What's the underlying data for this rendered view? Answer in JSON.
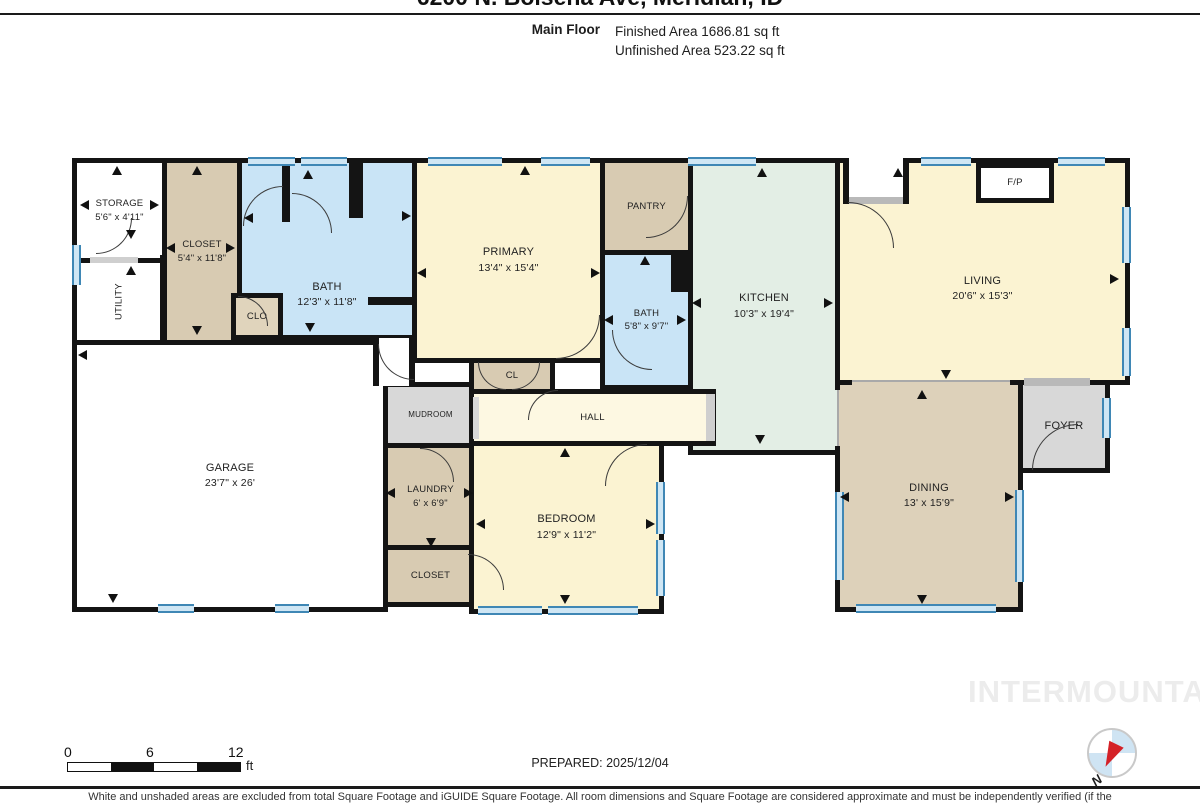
{
  "header": {
    "title": "6200 N. Bolsena Ave, Meridian, ID",
    "floor_label": "Main Floor",
    "finished_area": "Finished Area 1686.81 sq ft",
    "unfinished_area": "Unfinished Area 523.22 sq ft"
  },
  "rooms": {
    "storage": {
      "name": "STORAGE",
      "dims": "5'6\" x 4'11\""
    },
    "utility": {
      "name": "UTILITY",
      "dims": ""
    },
    "closet1": {
      "name": "CLOSET",
      "dims": "5'4\" x 11'8\""
    },
    "bath1": {
      "name": "BATH",
      "dims": "12'3\" x 11'8\""
    },
    "clo": {
      "name": "CLO",
      "dims": ""
    },
    "primary": {
      "name": "PRIMARY",
      "dims": "13'4\" x 15'4\""
    },
    "cl": {
      "name": "CL",
      "dims": ""
    },
    "pantry": {
      "name": "PANTRY",
      "dims": ""
    },
    "bath2": {
      "name": "BATH",
      "dims": "5'8\" x 9'7\""
    },
    "kitchen": {
      "name": "KITCHEN",
      "dims": "10'3\" x 19'4\""
    },
    "living": {
      "name": "LIVING",
      "dims": "20'6\" x 15'3\""
    },
    "fp": {
      "name": "F/P",
      "dims": ""
    },
    "foyer": {
      "name": "FOYER",
      "dims": ""
    },
    "dining": {
      "name": "DINING",
      "dims": "13' x 15'9\""
    },
    "garage": {
      "name": "GARAGE",
      "dims": "23'7\" x 26'"
    },
    "mudroom": {
      "name": "MUDROOM",
      "dims": ""
    },
    "hall": {
      "name": "HALL",
      "dims": ""
    },
    "laundry": {
      "name": "LAUNDRY",
      "dims": "6' x 6'9\""
    },
    "closet2": {
      "name": "CLOSET",
      "dims": ""
    },
    "bedroom": {
      "name": "BEDROOM",
      "dims": "12'9\" x 11'2\""
    }
  },
  "footer": {
    "scale": {
      "t0": "0",
      "t1": "6",
      "t2": "12",
      "unit": "ft"
    },
    "prepared": "PREPARED: 2025/12/04",
    "watermark": "INTERMOUNTAIN",
    "compass_label": "N",
    "disclaimer": "White and unshaded areas are excluded from total Square Footage and iGUIDE Square Footage. All room dimensions and Square Footage are considered approximate and must be independently verified (if the"
  },
  "colors": {
    "wall": "#141414",
    "bath_blue": "#c9e4f6",
    "bedroom_yellow": "#fbf3d2",
    "hall_cream": "#fdf8e2",
    "kitchen_green": "#e3eee5",
    "closet_tan": "#d8cbb2",
    "dining_tan": "#ddd1ba",
    "gray_room": "#d8d8d8",
    "window_blue": "#3f87b5"
  }
}
